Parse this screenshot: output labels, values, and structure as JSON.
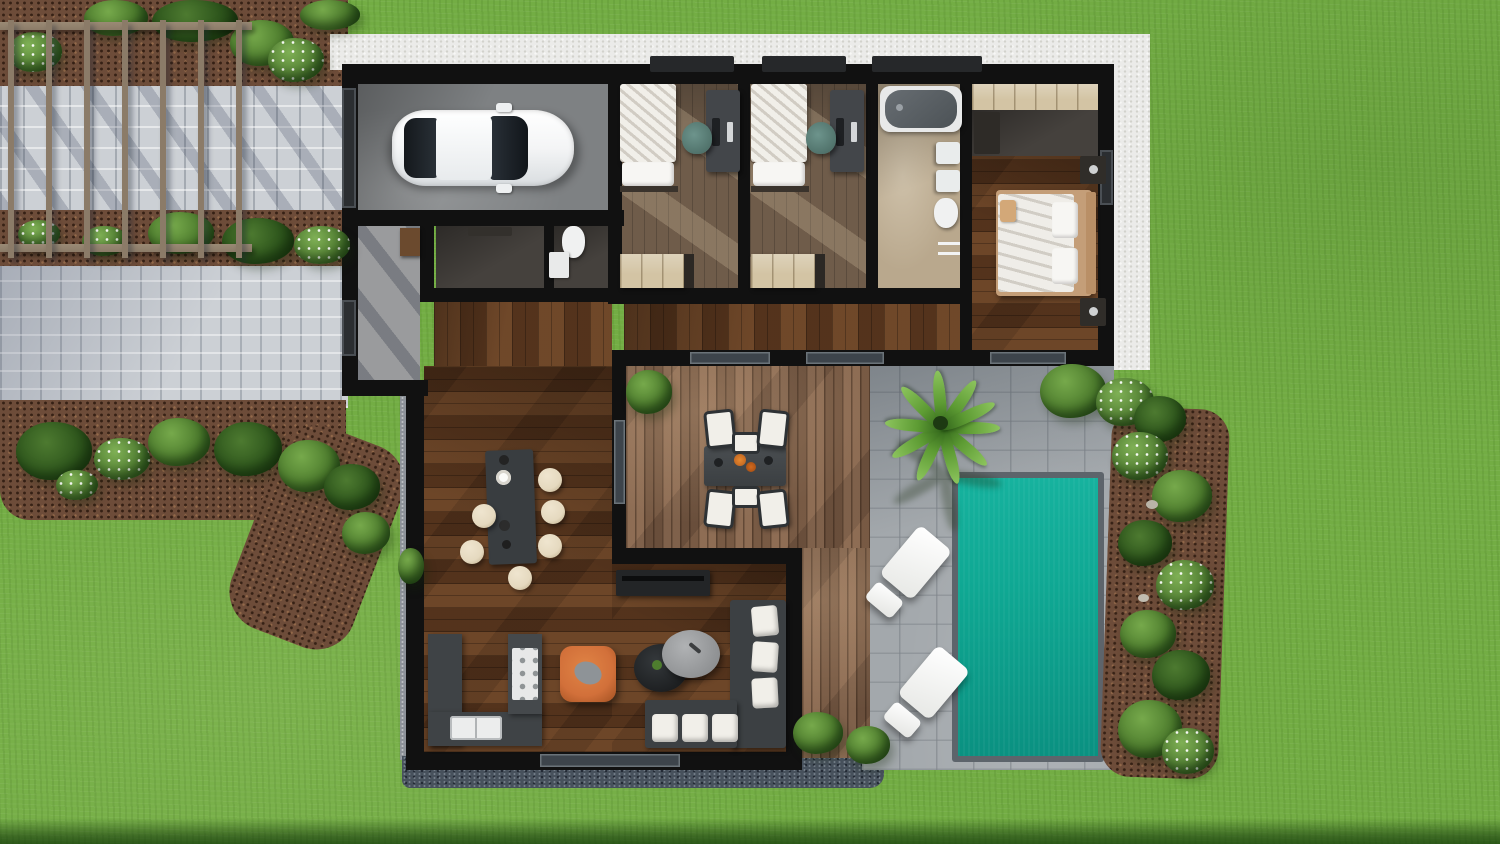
{
  "scene": {
    "type": "3d-floor-plan-top-view",
    "description": "Photorealistic top-down render of a single-storey villa: garage with car, two bedrooms with desks, family bathroom, master suite with wardrobe and dressing area, open-plan kitchen-living room, wooden dining deck, stone patio with palm tree and sun loungers, rectangular swimming pool, pergola walkway and landscaped mulch beds on a lawn",
    "rooms": [
      {
        "name": "garage",
        "floor": "concrete",
        "contents": [
          "white car"
        ]
      },
      {
        "name": "entry-hall",
        "floor": "concrete",
        "contents": [
          "cabinet"
        ]
      },
      {
        "name": "storage",
        "floor": "dark tile",
        "contents": [
          "shelf"
        ]
      },
      {
        "name": "wc",
        "floor": "dark tile",
        "contents": [
          "toilet",
          "cabinet"
        ]
      },
      {
        "name": "bedroom-1",
        "floor": "wood",
        "contents": [
          "single bed",
          "desk",
          "desk chair",
          "wardrobe"
        ]
      },
      {
        "name": "bedroom-2",
        "floor": "wood",
        "contents": [
          "single bed",
          "desk",
          "desk chair",
          "wardrobe"
        ]
      },
      {
        "name": "bathroom",
        "floor": "beige tile",
        "contents": [
          "bathtub",
          "double vanity",
          "toilet",
          "shower"
        ]
      },
      {
        "name": "master-bedroom",
        "floor": "wood",
        "contents": [
          "double bed",
          "pillows",
          "2 nightstands with lamps",
          "wardrobe",
          "dressing area"
        ]
      },
      {
        "name": "hallway",
        "floor": "wood",
        "contents": []
      },
      {
        "name": "living-kitchen",
        "floor": "wood",
        "contents": [
          "kitchen island",
          "6 bar stools",
          "L-shaped counter",
          "stove",
          "double sink",
          "tv console",
          "corner sofa with white cushions",
          "two oval coffee tables",
          "orange armchair"
        ]
      }
    ],
    "outdoor": [
      {
        "name": "dining-deck",
        "surface": "wood planks",
        "contents": [
          "dining table",
          "6 chairs",
          "3 shrubs"
        ]
      },
      {
        "name": "patio",
        "surface": "stone pavers",
        "contents": [
          "palm tree",
          "2 sun loungers"
        ]
      },
      {
        "name": "swimming-pool",
        "surface": "water"
      },
      {
        "name": "pergola-walkway",
        "surface": "light pavers",
        "contents": [
          "7 pergola posts",
          "2 rails"
        ]
      },
      {
        "name": "garden-beds",
        "surface": "mulch",
        "contents": [
          "shrubs",
          "white flowering plants"
        ]
      },
      {
        "name": "white-gravel-border",
        "surface": "gravel"
      },
      {
        "name": "lawn",
        "surface": "grass"
      }
    ],
    "counts": {
      "bedrooms": 3,
      "bar_stools": 6,
      "dining_chairs": 6,
      "sun_loungers": 2,
      "cars": 1,
      "pergola_posts": 7,
      "pools": 1
    }
  },
  "colors": {
    "grass": "#73ad44",
    "pool_water": "#0fa893",
    "pool_rim": "#5d646b",
    "wall": "#111111",
    "deck_wood": "#85644c",
    "wood_floor": "#5f3a20",
    "bedroom_wood": "#6f5c4a",
    "patio_stone": "#a3a8ac",
    "paver": "#ccd0d5",
    "mulch": "#6d4c39",
    "white_gravel": "#ebebe9",
    "gravel_dark": "#47515c",
    "concrete": "#7e8183",
    "tile_tan": "#b9a88d",
    "wardrobe_wood": "#d3c4a4",
    "furniture_dark": "#3a3e41",
    "cushion": "#f1efe9",
    "stool": "#e5d9bf",
    "armchair": "#d2703a",
    "car": "#f4f5f6",
    "foliage": "#4e7d2e",
    "foliage_dark": "#2f5a1e",
    "pergola": "#8b7b68"
  }
}
